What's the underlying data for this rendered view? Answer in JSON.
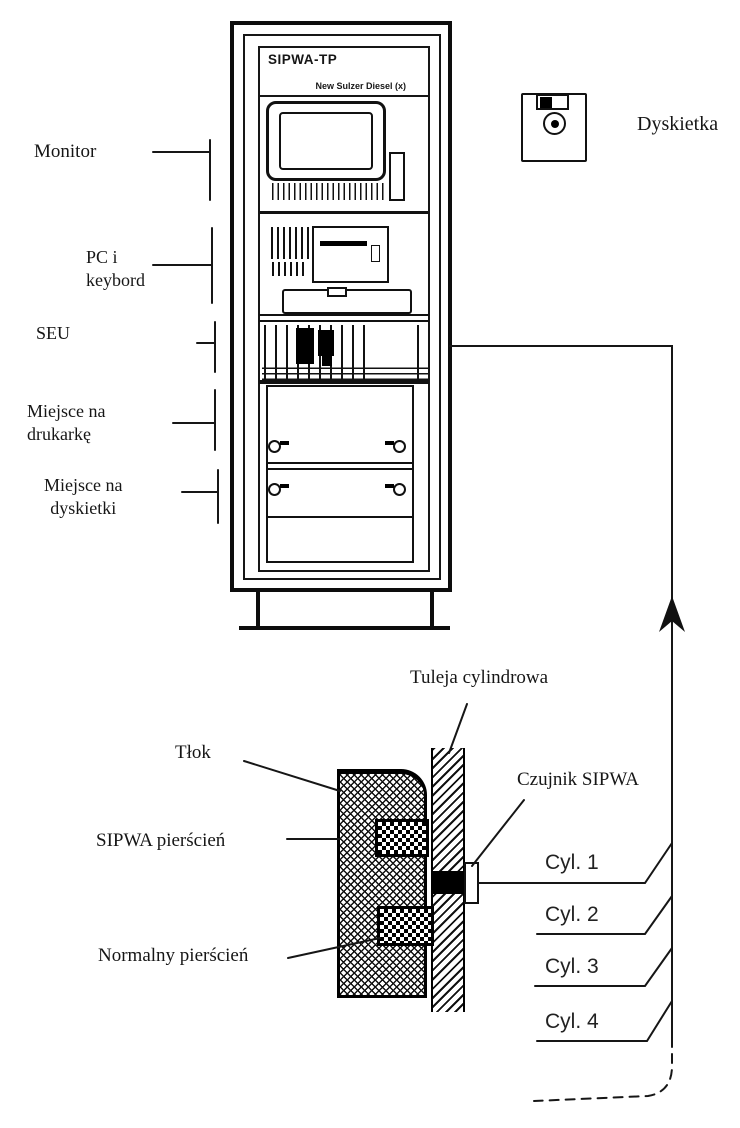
{
  "cabinet": {
    "title": "SIPWA-TP",
    "subtitle": "New Sulzer Diesel (x)"
  },
  "left_labels": {
    "monitor": "Monitor",
    "pc_keyboard_line1": "PC i",
    "pc_keyboard_line2": "keybord",
    "seu": "SEU",
    "printer_line1": "Miejsce na",
    "printer_line2": "drukarkę",
    "diskette_line1": "Miejsce na",
    "diskette_line2": "dyskietki"
  },
  "diskette": {
    "label": "Dyskietka"
  },
  "engine_section": {
    "cylinder_liner": "Tuleja cylindrowa",
    "piston": "Tłok",
    "sipwa_ring": "SIPWA pierścień",
    "sipwa_sensor": "Czujnik SIPWA",
    "normal_ring": "Normalny pierścień"
  },
  "cylinders": [
    {
      "label": "Cyl. 1"
    },
    {
      "label": "Cyl. 2"
    },
    {
      "label": "Cyl. 3"
    },
    {
      "label": "Cyl. 4"
    }
  ]
}
